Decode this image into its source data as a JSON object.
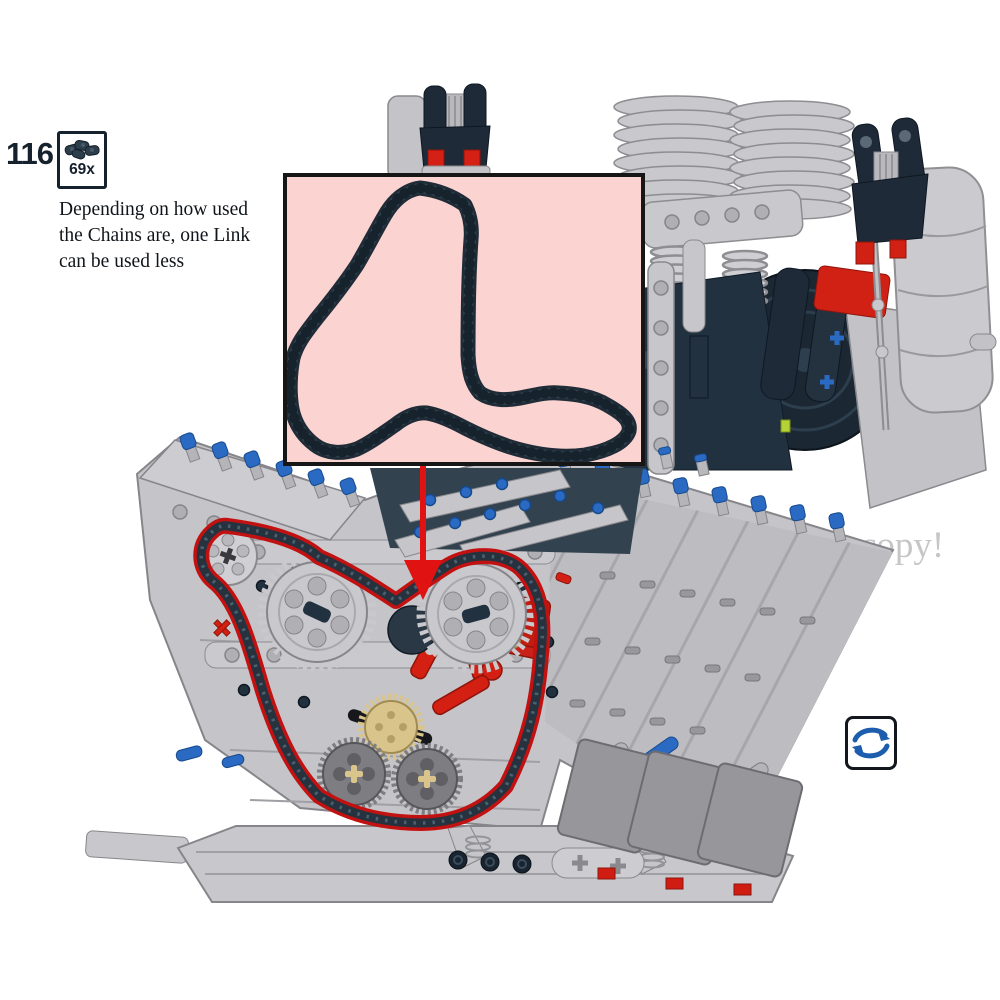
{
  "step": {
    "number": "116",
    "count": "69x"
  },
  "note": {
    "line1": "Depending on how used",
    "line2": "the Chains are, one Link",
    "line3": "can be used less"
  },
  "watermark": "copy!",
  "icons": {
    "parts_box": "chain-links-icon",
    "rotate": "rotate-model-icon"
  },
  "colors": {
    "accent_red": "#d32012",
    "pin_blue": "#2a6ac2",
    "chain_navy": "#2e4050",
    "chain_highlight": "#c21111",
    "inset_pink": "#fbd4d2",
    "lego_gray": "#c6c6ca",
    "lego_gray_dark": "#85858a",
    "navy_part": "#1e2a37",
    "tan_gear": "#d9c58c",
    "icon_blue": "#1d5dad",
    "watermark_gray": "#c6c6c6"
  }
}
